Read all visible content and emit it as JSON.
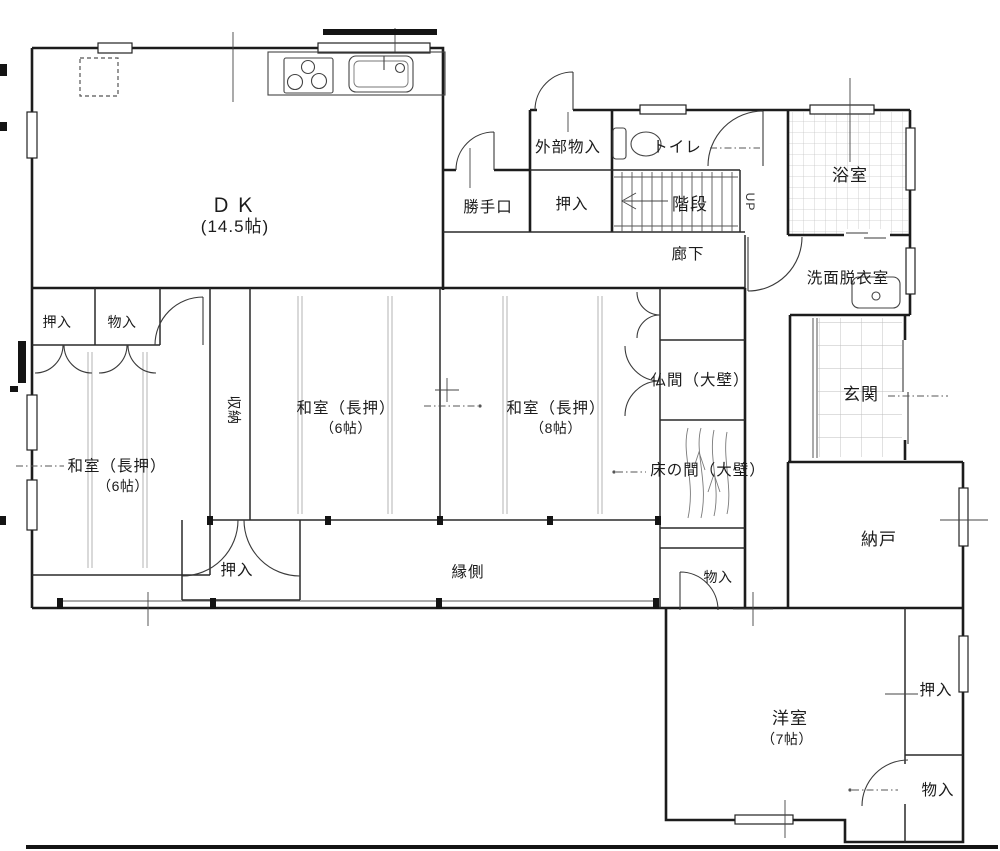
{
  "drawing": {
    "type": "japanese-house-floor-plan"
  },
  "labels": {
    "dk": "ＤＫ",
    "dk_size": "(14.5帖)",
    "gaibu_monoire": "外部物入",
    "katteguchi": "勝手口",
    "oshiire_top": "押入",
    "toilet": "トイレ",
    "kaidan": "階段",
    "up": "UP",
    "rouka": "廊下",
    "yokushitsu": "浴室",
    "senmen_datsuiishitsu": "洗面脱衣室",
    "oshiire_left": "押入",
    "monoire_left": "物入",
    "shuunou": "収納",
    "washitsu_center": "和室（長押）",
    "washitsu_center_size": "（6帖）",
    "washitsu_right": "和室（長押）",
    "washitsu_right_size": "（8帖）",
    "butsuma": "仏間（大壁）",
    "genkan": "玄関",
    "tokonoma": "床の間（大壁）",
    "washitsu_bl": "和室（長押）",
    "washitsu_bl_size": "（6帖）",
    "nando": "納戸",
    "oshiire_bottom": "押入",
    "engawa": "縁側",
    "monoire_center": "物入",
    "youshitsu": "洋室",
    "youshitsu_size": "（7帖）",
    "oshiire_br": "押入",
    "monoire_br": "物入"
  }
}
